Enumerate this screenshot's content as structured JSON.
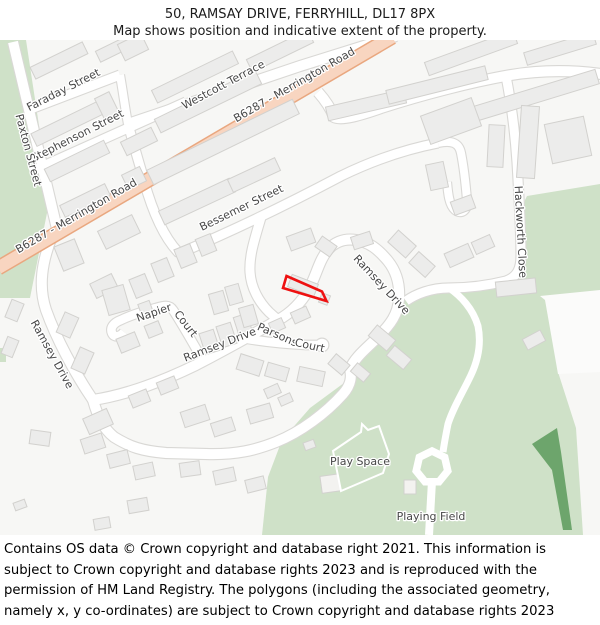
{
  "header": {
    "title": "50, RAMSAY DRIVE, FERRYHILL, DL17 8PX",
    "subtitle": "Map shows position and indicative extent of the property."
  },
  "map": {
    "colors": {
      "background": "#f7f7f5",
      "road_fill": "#ffffff",
      "road_casing": "#d9d8d5",
      "primary_road_fill": "#f8d5c0",
      "primary_road_casing": "#e9a77f",
      "building_fill": "#ececeb",
      "building_stroke": "#d2d1ce",
      "green_light": "#cfe1c8",
      "green_dark": "#6da56c",
      "label_color": "#474747",
      "property_outline": "#ee1111"
    },
    "labels": [
      {
        "text": "B6287 - Merrington Road"
      },
      {
        "text": "B6287 - Merrington Road"
      },
      {
        "text": "Westcott Terrace"
      },
      {
        "text": "Faraday Street"
      },
      {
        "text": "Stephenson Street"
      },
      {
        "text": "Paxton Street"
      },
      {
        "text": "Bessemer Street"
      },
      {
        "text": "Hackworth Close"
      },
      {
        "text": "Ramsey Drive"
      },
      {
        "text": "Ramsey Drive"
      },
      {
        "text": "Ramsey Drive"
      },
      {
        "text": "Napier"
      },
      {
        "text": "Court"
      },
      {
        "text": "Parsons"
      },
      {
        "text": "Court"
      },
      {
        "text": "Play Space"
      },
      {
        "text": "Playing Field"
      }
    ]
  },
  "footer": {
    "text": "Contains OS data © Crown copyright and database right 2021. This information is subject to Crown copyright and database rights 2023 and is reproduced with the permission of HM Land Registry. The polygons (including the associated geometry, namely x, y co-ordinates) are subject to Crown copyright and database rights 2023 Ordnance Survey 100026316."
  }
}
